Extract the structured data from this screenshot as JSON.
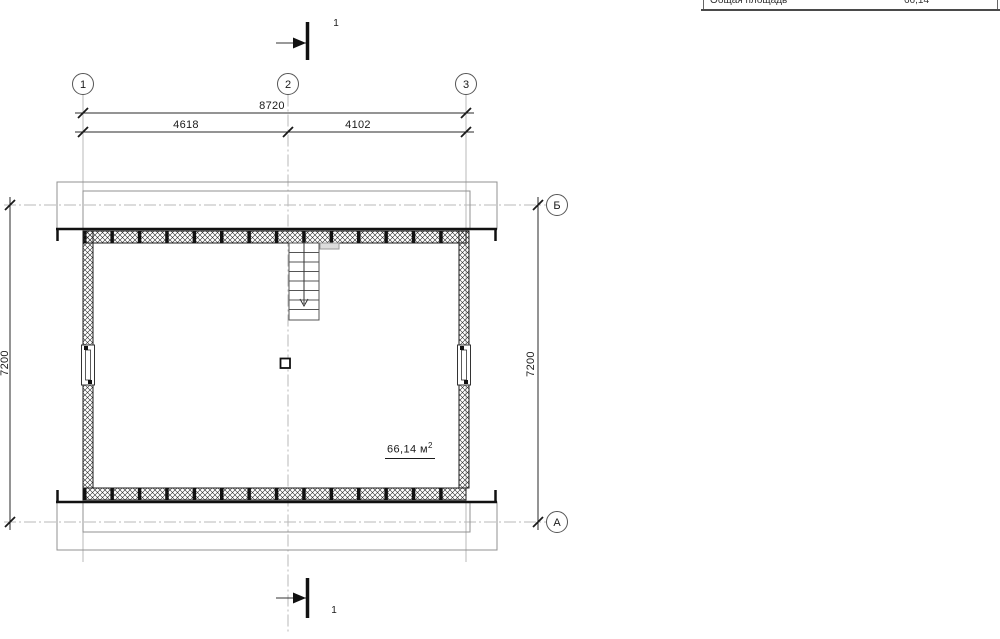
{
  "table_fragment": {
    "col1": "Общая площадь",
    "col2": "66,14"
  },
  "axes": {
    "v1": "1",
    "v2": "2",
    "v3": "3",
    "hB": "Б",
    "hA": "А"
  },
  "dims": {
    "total": "8720",
    "seg1": "4618",
    "seg2": "4102",
    "left": "7200",
    "right": "7200"
  },
  "section": {
    "top": "1",
    "bottom": "1"
  },
  "area": {
    "value": "66,14 м",
    "sup": "2"
  },
  "colors": {
    "line": "#1a1a1a",
    "grid": "#b8b8b8",
    "overhang": "#909090"
  }
}
